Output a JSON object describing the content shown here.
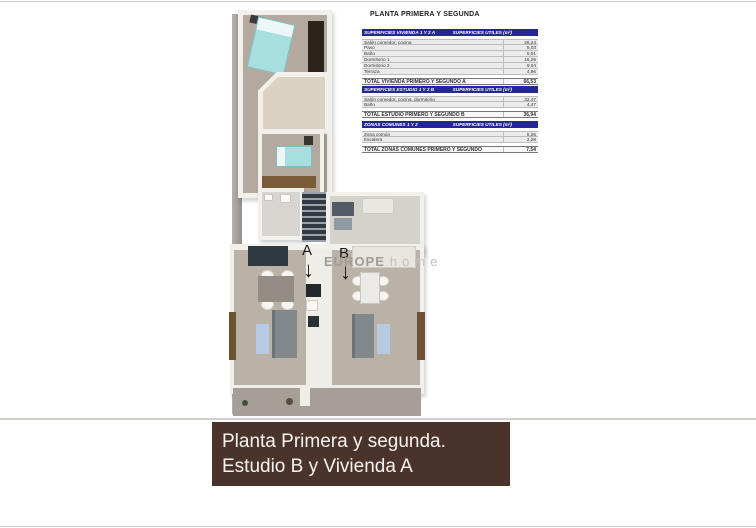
{
  "plan_title": "PLANTA PRIMERA Y SEGUNDA",
  "tables": {
    "vivienda": {
      "header_left": "SUPERFICIES VIVIENDA 1 Y 2 A",
      "header_right": "SUPERFICIES UTILES  (m²)",
      "rows": [
        {
          "label": "Salón comedor, cocina",
          "value": "26,24"
        },
        {
          "label": "Paso",
          "value": "5,03"
        },
        {
          "label": "Baño",
          "value": "5,01"
        },
        {
          "label": "Dormitorio 1",
          "value": "16,25"
        },
        {
          "label": "Dormitorio 2",
          "value": "9,04"
        },
        {
          "label": "Terraza",
          "value": "4,96"
        }
      ],
      "total_label": "TOTAL VIVIENDA PRIMERO Y SEGUNDO A",
      "total_value": "66,53"
    },
    "estudio": {
      "header_left": "SUPERFICIES ESTUDIO 1 Y 2 B",
      "header_right": "SUPERFICIES UTILES  (m²)",
      "rows": [
        {
          "label": "Salón comedor, cocina, dormitorio",
          "value": "32,47"
        },
        {
          "label": "Baño",
          "value": "4,47"
        }
      ],
      "total_label": "TOTAL ESTUDIO PRIMERO Y SEGUNDO B",
      "total_value": "36,94"
    },
    "comunes": {
      "header_left": "ZONAS COMUNES 1 Y 2",
      "header_right": "SUPERFICIES UTILES  (m²)",
      "rows": [
        {
          "label": "Zona común",
          "value": "5,26"
        },
        {
          "label": "Escalera",
          "value": "2,28"
        }
      ],
      "total_label": "TOTAL ZONAS COMUNES PRIMERO Y SEGUNDO",
      "total_value": "7,54"
    }
  },
  "plan": {
    "unit_a_label": "A",
    "unit_b_label": "B",
    "arrow_glyph": "↓"
  },
  "watermark": {
    "brand_bold": "EUROPE",
    "brand_light": "home"
  },
  "caption": {
    "line1": "Planta Primera y segunda.",
    "line2": "Estudio B y Vivienda A"
  },
  "colors": {
    "table_header_blue": "#232896",
    "caption_brown": "#4a332b",
    "bed_teal": "#a7dfe1",
    "rug_blue": "#b6cae2",
    "wardrobe_dark": "#2b231c",
    "wood_brown": "#7b5c38",
    "floor_taupe": "#b3a99e",
    "terrace_beige": "#dcd2c2"
  }
}
